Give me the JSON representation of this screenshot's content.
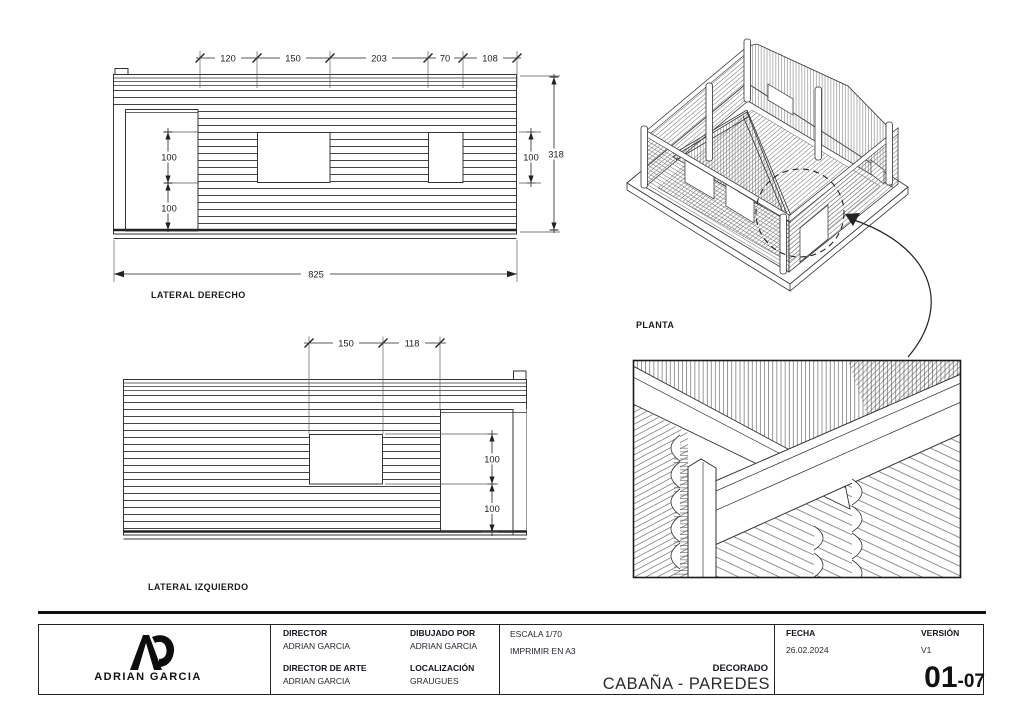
{
  "elevations": {
    "right": {
      "label": "LATERAL DERECHO",
      "dims_top": [
        "120",
        "150",
        "203",
        "70",
        "108"
      ],
      "dims_height_left": [
        "100",
        "100"
      ],
      "dim_window_height": "100",
      "dim_total_height": "318",
      "dim_total_width": "825"
    },
    "left": {
      "label": "LATERAL IZQUIERDO",
      "dims_top": [
        "150",
        "118"
      ],
      "dims_height_right": [
        "100",
        "100"
      ]
    }
  },
  "isometric": {
    "label": "PLANTA"
  },
  "title_block": {
    "logo": {
      "monogram": "AG",
      "name": "ADRIAN GARCIA"
    },
    "fields": {
      "director": {
        "label": "DIRECTOR",
        "value": "ADRIAN GARCIA"
      },
      "art_director": {
        "label": "DIRECTOR DE ARTE",
        "value": "ADRIAN GARCIA"
      },
      "drawn_by": {
        "label": "DIBUJADO POR",
        "value": "ADRIAN GARCIA"
      },
      "location": {
        "label": "LOCALIZACIÓN",
        "value": "GRAUGUES"
      },
      "scale": "ESCALA 1/70",
      "print_format": "IMPRIMIR EN A3",
      "set_label": "DECORADO",
      "set_title": "CABAÑA - PAREDES",
      "date": {
        "label": "FECHA",
        "value": "26.02.2024"
      },
      "version": {
        "label": "VERSIÓN",
        "value": "V1"
      }
    },
    "sheet_number": {
      "major": "01",
      "separator": "-",
      "minor": "07"
    }
  },
  "colors": {
    "line": "#333333",
    "text": "#1c1c1c",
    "background": "#ffffff"
  }
}
